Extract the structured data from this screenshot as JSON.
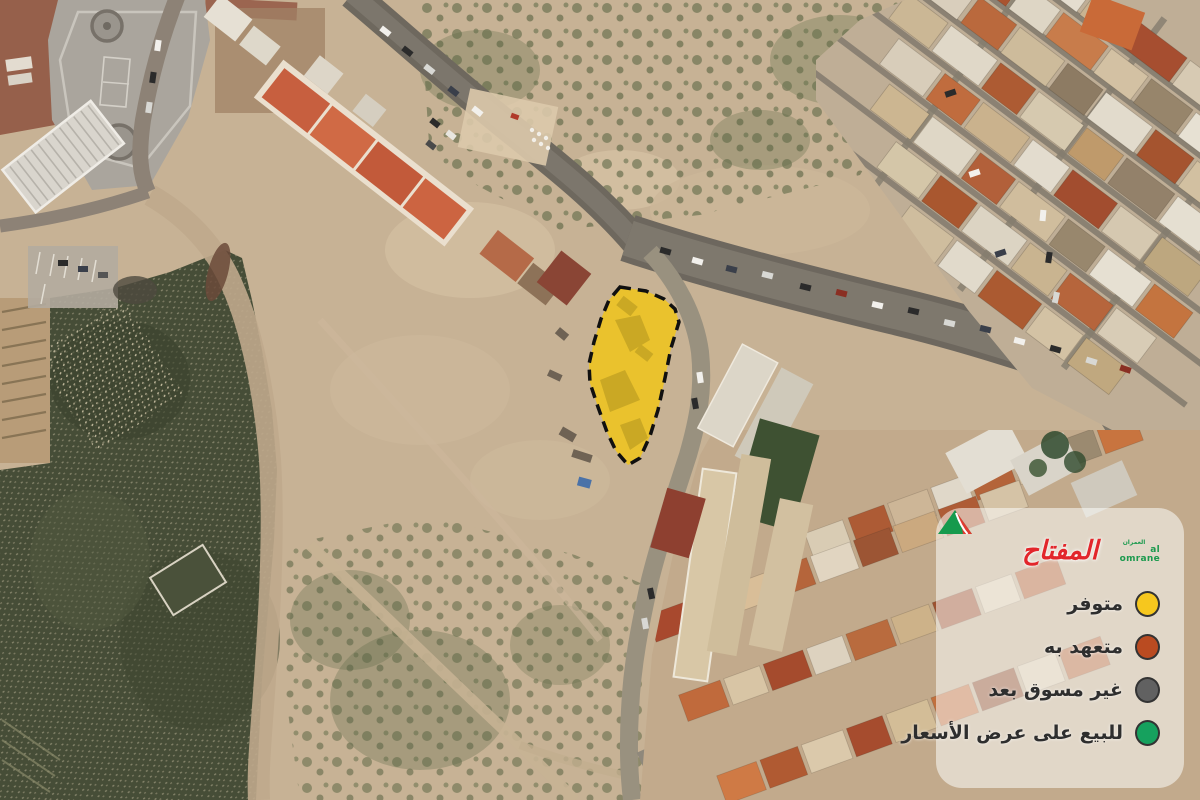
{
  "map": {
    "parcel": {
      "fill": "#EFC41F",
      "points": "620,287 646,291 664,299 675,309 679,322 671,348 665,378 658,410 650,436 640,458 628,465 616,451 607,432 598,407 590,383 589,364 594,342 601,319 609,300"
    }
  },
  "legend": {
    "title": "المفتاح",
    "logo": {
      "arabic": "العمران",
      "latin": "al omrane"
    },
    "items": [
      {
        "label": "متوفر",
        "color": "#F6C71E"
      },
      {
        "label": "متعهد به",
        "color": "#BA4B21"
      },
      {
        "label": "غير مسوق بعد",
        "color": "#616161"
      },
      {
        "label": "للبيع على عرض الأسعار",
        "color": "#16A15E"
      }
    ]
  }
}
